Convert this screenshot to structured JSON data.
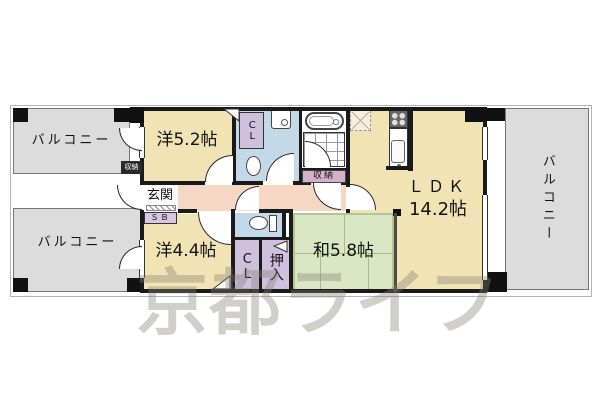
{
  "watermark": "京都ライフ",
  "balconies": {
    "top_left": "バルコニー",
    "bottom_left": "バルコニー",
    "right": "バルコニー"
  },
  "rooms": {
    "western_52": "洋5.2帖",
    "western_44": "洋4.4帖",
    "japanese_58": "和5.8帖",
    "ldk": "ＬＤＫ",
    "ldk_size": "14.2帖",
    "entrance": "玄関"
  },
  "storage": {
    "closet_upper": "CL",
    "closet_lower": "CL",
    "oshiire": "押入",
    "shoe_box": "ＳＢ",
    "bath_storage": "収納",
    "exterior_storage": "収納"
  },
  "colors": {
    "room_yellow": "#f2e3b4",
    "tatami_green": "#dbe6c4",
    "wet_area_blue": "#c3d9e8",
    "hall_pink": "#f6d7c3",
    "closet_purple": "#cfc0de",
    "bath_storage_pink": "#d4afc9",
    "balcony_gray": "#dcdcdc",
    "wall_black": "#1a1a1a"
  }
}
